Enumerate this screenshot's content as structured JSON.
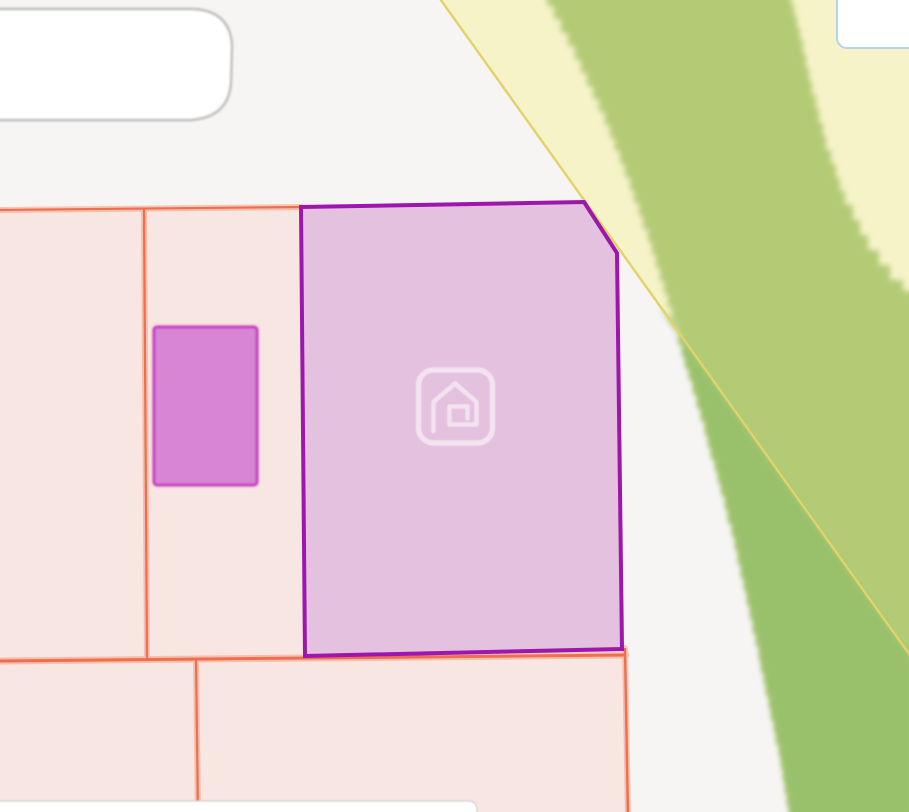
{
  "app": {
    "title": "Parcel map view",
    "description": "Zoomed-in real estate map tile showing a selected parcel with house watermark"
  },
  "colors": {
    "bg_gray": "#f6f5f4",
    "pale_yellow_area": "#f6f3c9",
    "yellow_boundary_line": "#e3d268",
    "green_band_light": "#b4cb76",
    "green_band_dark": "#99c16c",
    "pink_parcel": "#f7e6e1",
    "orange_parcel_line": "#ee6848",
    "orange_parcel_line_halo": "#f2926f",
    "selected_parcel_fill": "#e4c1de",
    "selected_parcel_border": "#9d16ae",
    "magenta_building_fill": "#d885d6",
    "magenta_building_border": "#c437c0",
    "building_fill": "#ffffff",
    "building_outline": "#bdbab8",
    "building_outline_light": "#d9d5d3",
    "ui_card_fill": "#ffffff",
    "ui_card_border": "#b4d3ec",
    "watermark_stroke": "rgba(255,255,255,0.55)"
  },
  "icons": {
    "house_watermark": "house-logo-watermark"
  },
  "layers": {
    "background": "open land / road background",
    "pale_yellow": "open land area",
    "green_band": "tree line band",
    "parcels": "residential parcel block",
    "selected_parcel": "highlighted listing parcel",
    "ui_card": "map control card (clipped at top-right)"
  }
}
